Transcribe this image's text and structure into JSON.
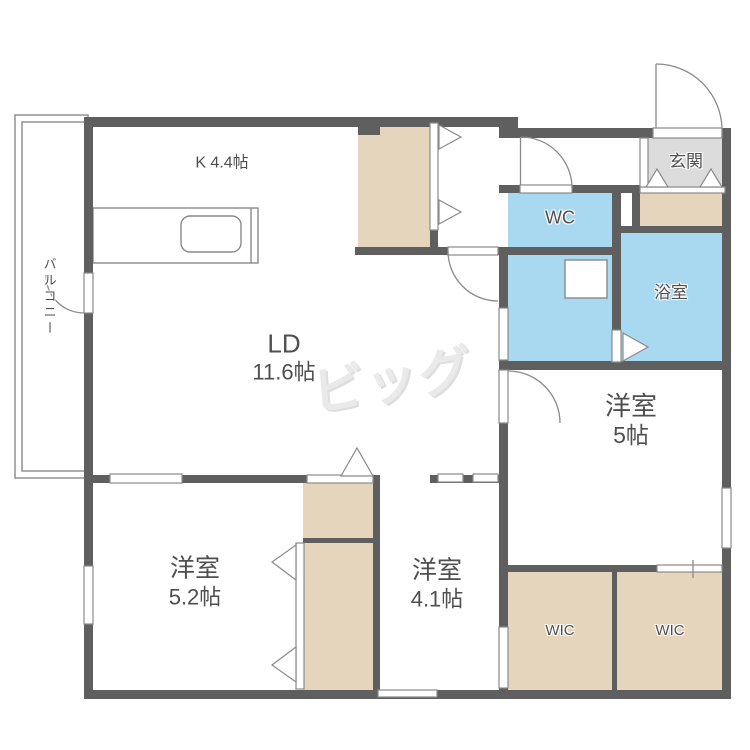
{
  "floorplan": {
    "rooms": {
      "kitchen": {
        "label": "K 4.4帖"
      },
      "living_dining": {
        "name": "LD",
        "size": "11.6帖"
      },
      "bedroom_5": {
        "name": "洋室",
        "size": "5帖"
      },
      "bedroom_5_2": {
        "name": "洋室",
        "size": "5.2帖"
      },
      "bedroom_4_1": {
        "name": "洋室",
        "size": "4.1帖"
      },
      "wc": {
        "label": "WC"
      },
      "bathroom": {
        "label": "浴室"
      },
      "entrance": {
        "label": "玄関"
      },
      "balcony": {
        "label": "バルコニー"
      },
      "wic_left": {
        "label": "WIC"
      },
      "wic_right": {
        "label": "WIC"
      }
    },
    "watermark": {
      "text": "ビッグ"
    },
    "colors": {
      "wall": "#5f5f5f",
      "wet_room_fill": "#a8d9f0",
      "storage_fill": "#e6d5bd",
      "entrance_floor_fill": "#dcdcdc",
      "thin_line": "#8a8a8a",
      "label_text": "#4f4f4f",
      "watermark": "#eaeaea"
    }
  }
}
